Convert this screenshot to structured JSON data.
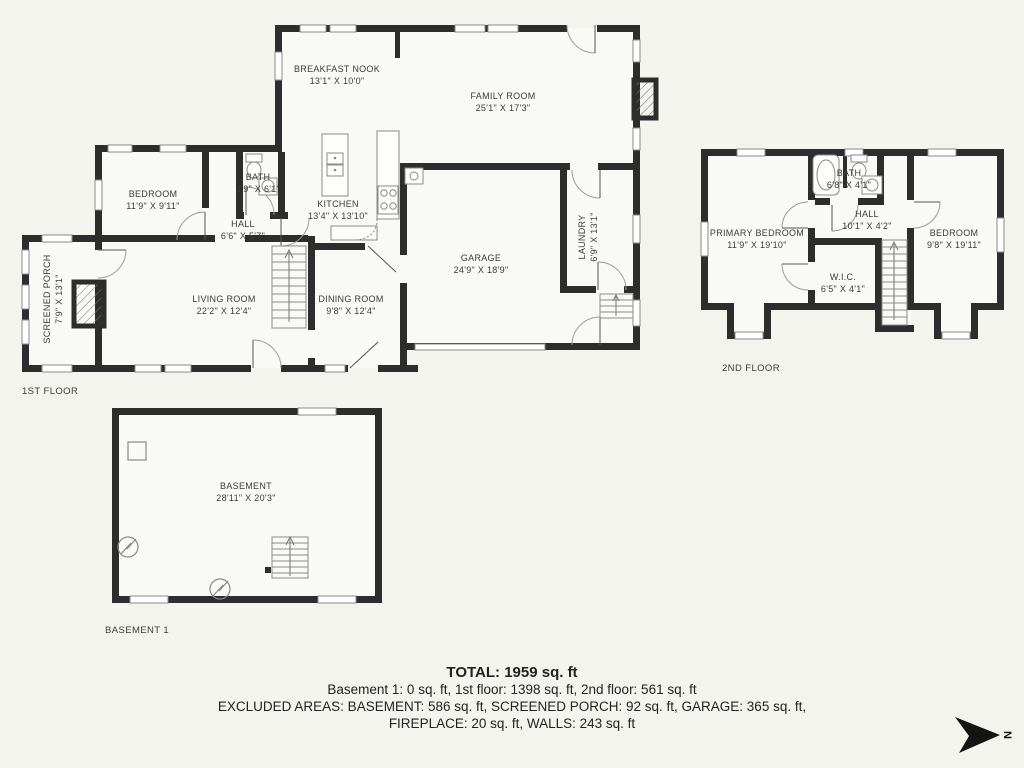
{
  "colors": {
    "background": "#f4f4ef",
    "floor_fill": "#f9f9f5",
    "wall": "#2d2d2d",
    "fixture_stroke": "#8a8a8a",
    "door_arc": "#9a9a9a",
    "text": "#3b3b3b"
  },
  "floors": {
    "first": {
      "label": "1ST FLOOR",
      "rooms": {
        "breakfast_nook": {
          "name": "BREAKFAST NOOK",
          "dims": "13'1\" X 10'0\""
        },
        "family_room": {
          "name": "FAMILY ROOM",
          "dims": "25'1\" X 17'3\""
        },
        "bedroom": {
          "name": "BEDROOM",
          "dims": "11'9\" X 9'11\""
        },
        "bath": {
          "name": "BATH",
          "dims": "3'9\" X 6'1\""
        },
        "hall": {
          "name": "HALL",
          "dims": "6'6\" X 5'7\""
        },
        "kitchen": {
          "name": "KITCHEN",
          "dims": "13'4\" X 13'10\""
        },
        "garage": {
          "name": "GARAGE",
          "dims": "24'9\" X 18'9\""
        },
        "laundry": {
          "name": "LAUNDRY",
          "dims": "6'9\" X 13'1\""
        },
        "screened_porch": {
          "name": "SCREENED PORCH",
          "dims": "7'9\" X 13'1\""
        },
        "living_room": {
          "name": "LIVING ROOM",
          "dims": "22'2\" X 12'4\""
        },
        "dining_room": {
          "name": "DINING ROOM",
          "dims": "9'8\" X 12'4\""
        }
      }
    },
    "second": {
      "label": "2ND FLOOR",
      "rooms": {
        "primary_bedroom": {
          "name": "PRIMARY BEDROOM",
          "dims": "11'9\" X 19'10\""
        },
        "bath": {
          "name": "BATH",
          "dims": "6'8\" X 4'1\""
        },
        "hall": {
          "name": "HALL",
          "dims": "10'1\" X 4'2\""
        },
        "bedroom": {
          "name": "BEDROOM",
          "dims": "9'8\" X 19'11\""
        },
        "wic": {
          "name": "W.I.C.",
          "dims": "6'5\" X 4'1\""
        }
      }
    },
    "basement": {
      "label": "BASEMENT 1",
      "rooms": {
        "basement": {
          "name": "BASEMENT",
          "dims": "28'11\" X 20'3\""
        }
      }
    }
  },
  "summary": {
    "total": "TOTAL: 1959 sq. ft",
    "floors_line": "Basement 1: 0 sq. ft, 1st floor: 1398 sq. ft, 2nd floor: 561 sq. ft",
    "excluded_line1": "EXCLUDED AREAS: BASEMENT: 586 sq. ft, SCREENED PORCH: 92 sq. ft, GARAGE: 365 sq. ft,",
    "excluded_line2": "FIREPLACE: 20 sq. ft, WALLS: 243 sq. ft"
  },
  "compass": {
    "north_letter": "N"
  }
}
